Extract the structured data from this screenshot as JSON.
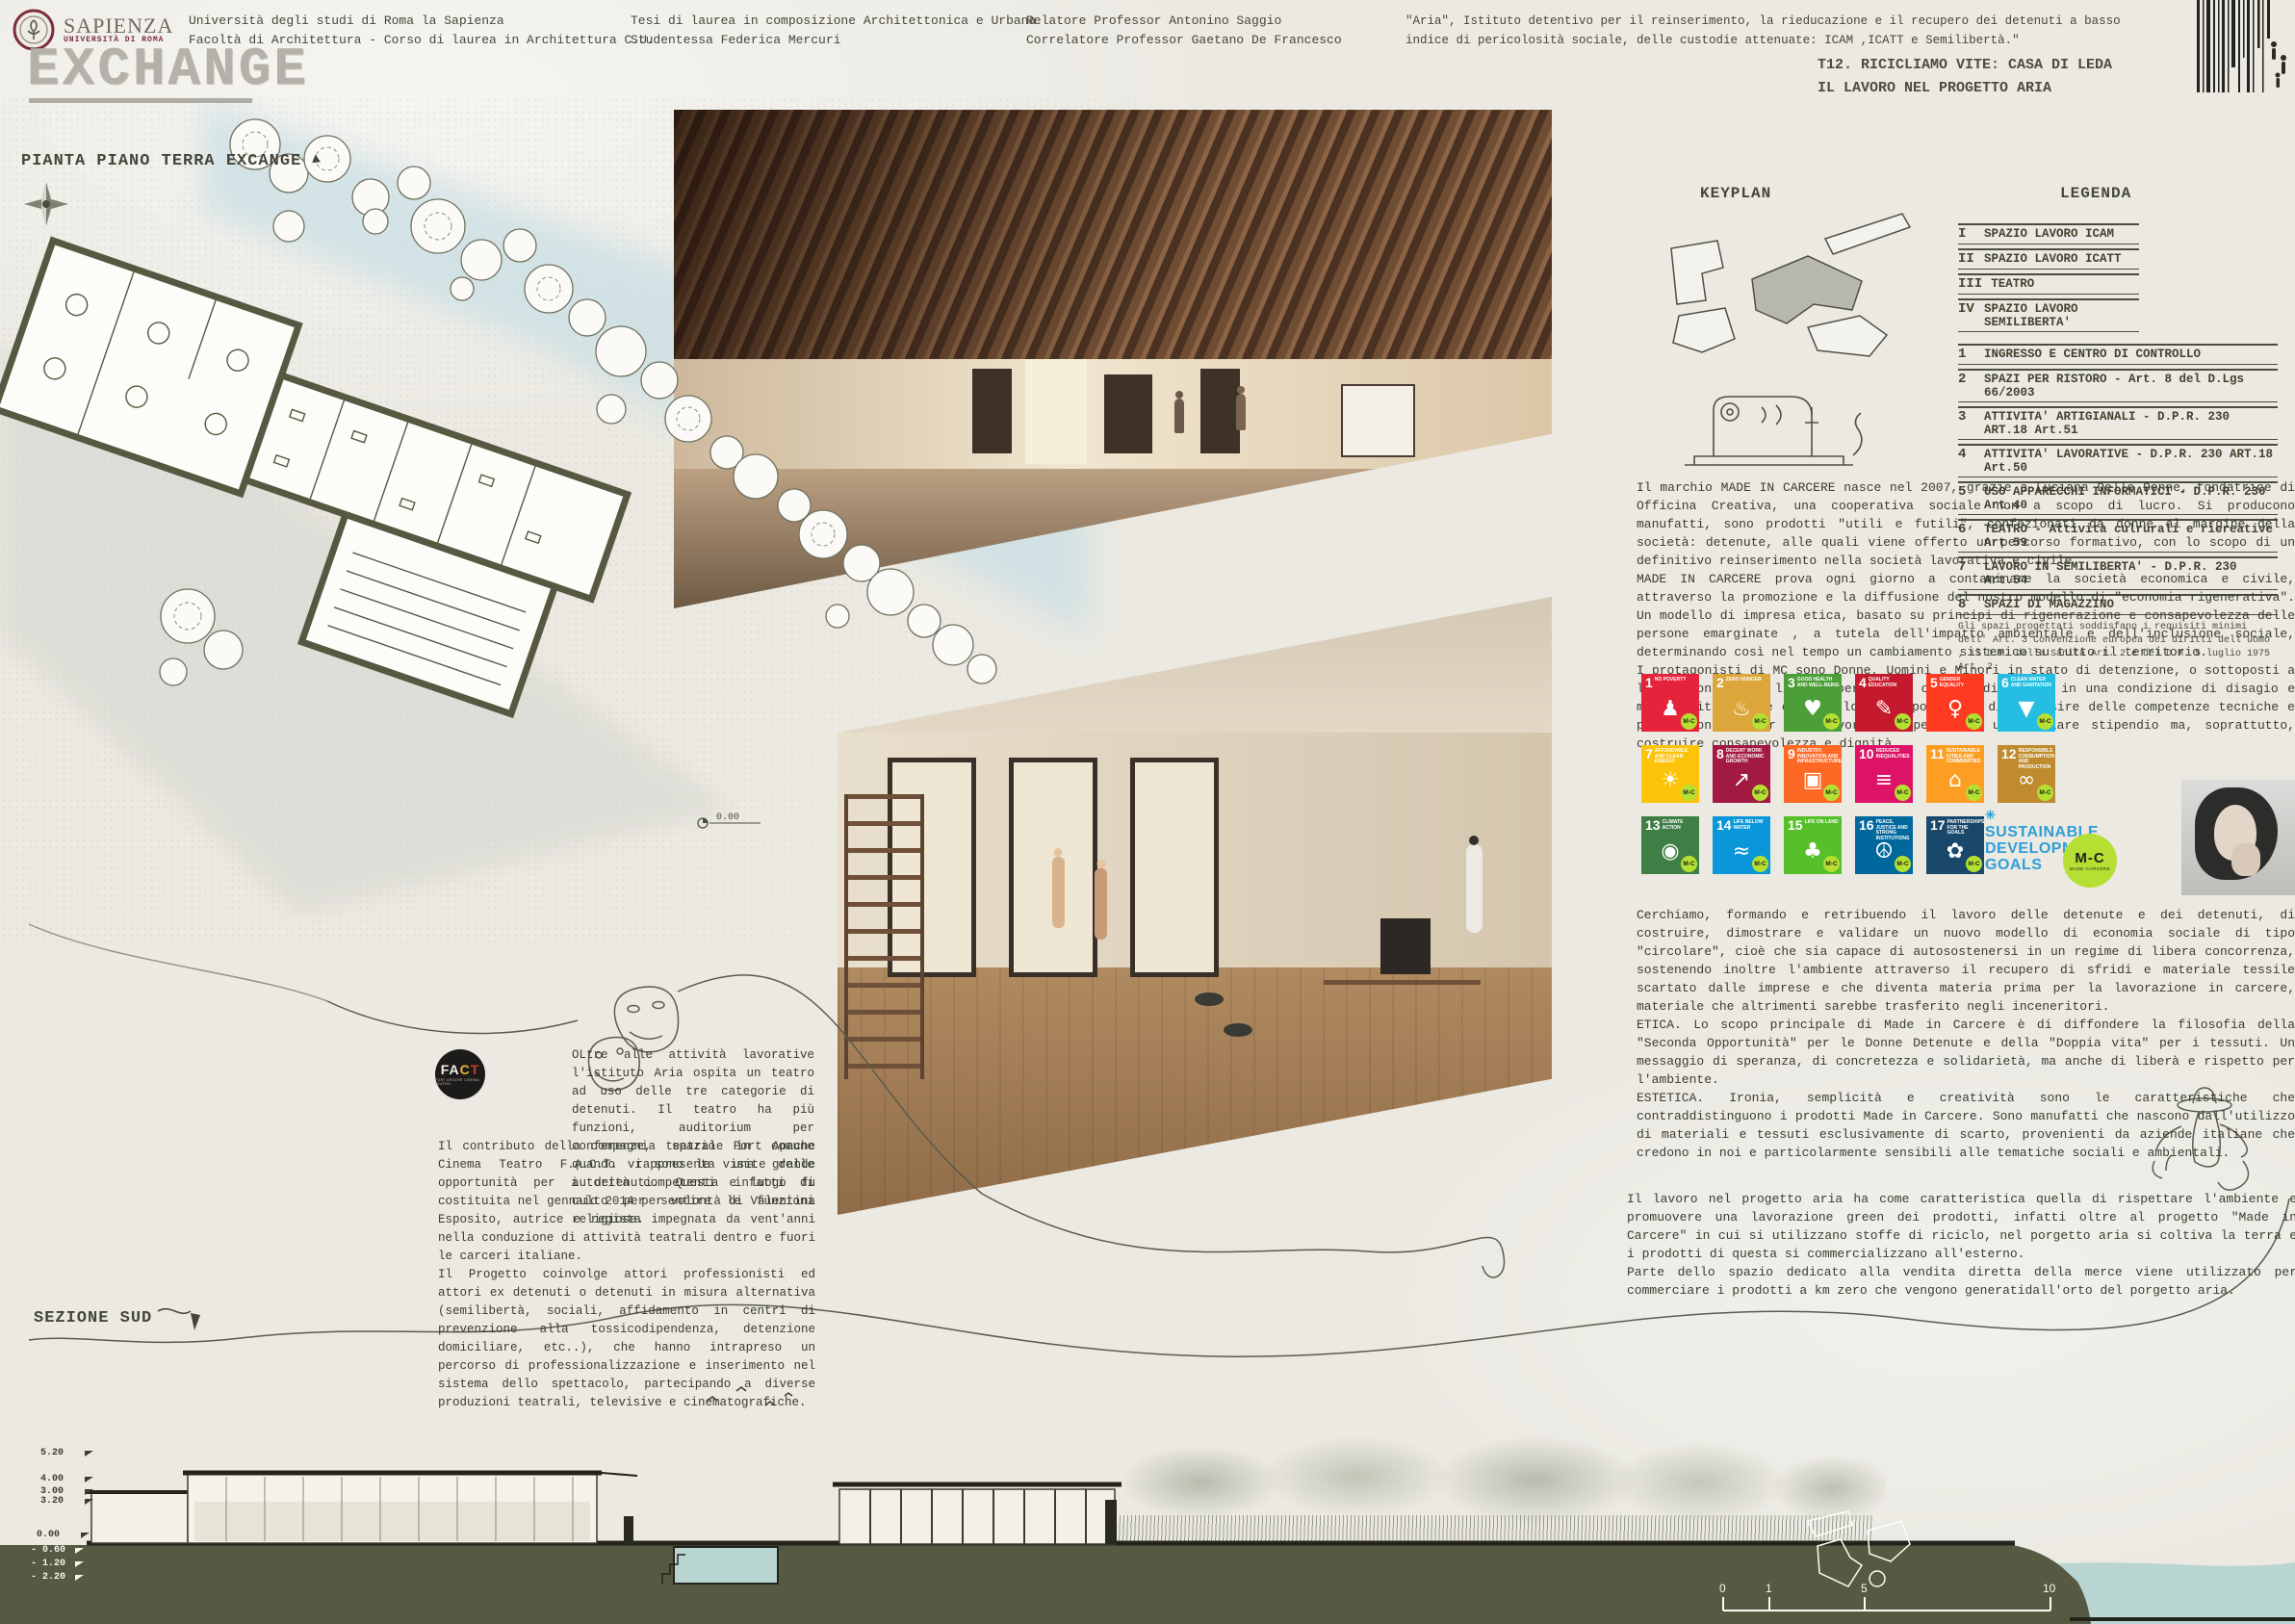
{
  "header": {
    "logo_title": "SAPIENZA",
    "logo_subtitle": "UNIVERSITÀ DI ROMA",
    "university": "Università degli studi di Roma la Sapienza",
    "faculty": "Facoltà di Architettura - Corso di laurea in Architettura C.U.",
    "thesis": "Tesi di laurea in composizione Architettonica e Urbana",
    "student": "Studentessa Federica Mercuri",
    "advisor": "Relatore Professor Antonino Saggio",
    "co_advisor": "Correlatore Professor Gaetano De Francesco",
    "quote": "\"Aria\",  Istituto detentivo per il reinserimento, la rieducazione  e il recupero dei detenuti a basso indice di pericolosità sociale, delle custodie attenuate: ICAM ,ICATT e Semilibertà.\"",
    "board_title_1": "T12. RICICLIAMO VITE: CASA DI LEDA",
    "board_title_2": "IL LAVORO NEL PROGETTO ARIA"
  },
  "titles": {
    "main": "EXCHANGE",
    "plan_label": "PIANTA PIANO TERRA EXCANGE",
    "section_label": "SEZIONE SUD",
    "keyplan": "KEYPLAN",
    "legend": "LEGENDA"
  },
  "plan": {
    "level_label": "0.00"
  },
  "legend": {
    "roman_items": [
      {
        "num": "I",
        "label": "SPAZIO LAVORO ICAM"
      },
      {
        "num": "II",
        "label": "SPAZIO LAVORO ICATT"
      },
      {
        "num": "III",
        "label": "TEATRO"
      },
      {
        "num": "IV",
        "label": "SPAZIO LAVORO SEMILIBERTA'"
      }
    ],
    "numbered_items": [
      {
        "num": "1",
        "label": "INGRESSO E CENTRO DI CONTROLLO"
      },
      {
        "num": "2",
        "label": "SPAZI PER RISTORO - Art. 8 del D.Lgs 66/2003"
      },
      {
        "num": "3",
        "label": "ATTIVITA' ARTIGIANALI - D.P.R. 230 ART.18 Art.51"
      },
      {
        "num": "4",
        "label": "ATTIVITA' LAVORATIVE - D.P.R. 230 ART.18 Art.50"
      },
      {
        "num": "5",
        "label": "USO APPARECCHI INFORMATICI - D.P.R. 230 Art.40"
      },
      {
        "num": "6",
        "label": "TEATRO - Attività culrurali e ricreative Art 59"
      },
      {
        "num": "7",
        "label": "LAVORO IN SEMILIBERTA' - D.P.R. 230 Art.54"
      },
      {
        "num": "8",
        "label": "SPAZI DI MAGAZZINO"
      }
    ],
    "note": "Gli spazi progettati soddisfano i requisiti minimi dell' Art. 3 Convenzione europea dei diritti dell'uomo , il D.M. della Sanità Art. 2  e del D.M. 5 luglio 1975 Art. 2"
  },
  "paragraphs": {
    "made_in_carcere": "Il marchio MADE IN CARCERE nasce nel 2007, grazie a Luciana Delle Donne, fondatrice di Officina Creativa, una cooperativa sociale non a scopo di lucro. Si producono manufatti, sono prodotti \"utili e futili\", confezionati da donne al margine della società: detenute, alle quali viene offerto un percorso formativo, con lo scopo di un definitivo reinserimento nella società lavorativa e civile.\nMADE IN CARCERE prova ogni giorno a contaminare la società economica e civile, attraverso la promozione e la diffusione del nostro modello di \"economia rigenerativa\". Un modello di impresa etica, basato su principi di rigenerazione e consapevolezza delle persone emarginate , a tutela dell'impatto ambientale e dell'inclusione sociale, determinando così nel tempo un cambiamento sistemico su tutto il territorio.\nI protagonisti di MC sono Donne, Uomini e Minori in stato di detenzione, o sottoposti a limitazioni della libertà personale, che quindi vivono in una condizione di disagio e marginalità. Viene offerta loro l'opportunità  di acquisire delle competenze tecniche e professionali, per poi lavorare e percepire un regolare stipendio  ma, soprattutto, costruire consapevolezza e dignità.",
    "cerchiamo": "Cerchiamo, formando e retribuendo il lavoro delle detenute e dei detenuti, di costruire, dimostrare e validare un nuovo modello di economia sociale di tipo \"circolare\", cioè che sia capace di autosostenersi in un regime di libera concorrenza, sostenendo inoltre l'ambiente attraverso il recupero di sfridi e materiale tessile scartato dalle imprese e che diventa materia prima per la lavorazione in carcere, materiale che altrimenti sarebbe  trasferito negli inceneritori.\nETICA. Lo scopo principale di Made in Carcere è di diffondere la filosofia della \"Seconda Opportunità\" per le Donne Detenute e della \"Doppia vita\" per i tessuti. Un messaggio di speranza, di concretezza e solidarietà, ma anche di liberà e rispetto per l'ambiente.\nESTETICA. Ironia, semplicità e creatività sono le caratteristiche che contraddistinguono i prodotti Made in Carcere. Sono manufatti che nascono dall'utilizzo di materiali e tessuti esclusivamente di scarto, provenienti da aziende italiane che credono in noi e particolarmente sensibili alle tematiche sociali e ambientali.",
    "lavoro_aria": "Il lavoro nel progetto aria ha come caratteristica quella di rispettare l'ambiente e promuovere una lavorazione green dei prodotti, infatti oltre al progetto \"Made in Carcere\" in cui si utilizzano stoffe di riciclo, nel porgetto aria si coltiva la terra e i prodotti di questa si commercializzano all'esterno.\nParte dello spazio dedicato alla vendita diretta della merce viene utilizzato per commerciare i prodotti a km zero che vengono generatidall'orto del porgetto aria.",
    "fact_intro": "OLtre alle attività lavorative l'istituto Aria ospita un teatro ad uso delle tre categorie di detenuti. Il teatro ha più funzioni, auditorium per conferenze, spazio in comune quando vi sono le visite delle autorità competenti e luogo di culto per sentire le funzioni religiose.",
    "fact_body": "Il contributo della compagnia teatrale Fort Apache Cinema Teatro F.A.C.T. rappresenta una grande opportunità per i detenuti. Questa infatti  fu costituita nel gennaio 2014 per volontà di Valentina Esposito, autrice e regista impegnata da  vent'anni nella conduzione di attività teatrali dentro e fuori le carceri italiane.\nIl Progetto coinvolge attori professionisti ed attori ex detenuti o detenuti in misura alternativa (semilibertà, sociali, affidamento in centri di prevenzione alla tossicodipendenza, detenzione domiciliare, etc..), che hanno intrapreso un percorso di professionalizzazione e inserimento nel sistema dello spettacolo, partecipando a diverse produzioni teatrali, televisive e cinematografiche."
  },
  "fact_logo": {
    "letters": [
      "F",
      "A",
      "C",
      "T"
    ],
    "letter_colors": [
      "#f2f0ea",
      "#f2f0ea",
      "#e9b23c",
      "#c23b2e"
    ],
    "sub": "FORT APACHE CINEMA TEATRO"
  },
  "sdg": {
    "badge": "M-C",
    "logo_line1": "SUSTAINABLE",
    "logo_line2": "DEVELOPMENT",
    "logo_line3": "GOALS",
    "mc_circle": {
      "text": "M-C",
      "sub": "MADE-CARCERE",
      "color": "#b5df33"
    },
    "tiles": [
      {
        "num": "1",
        "label": "NO POVERTY",
        "glyph": "♟",
        "color": "#e5243b"
      },
      {
        "num": "2",
        "label": "ZERO HUNGER",
        "glyph": "♨",
        "color": "#dda63a"
      },
      {
        "num": "3",
        "label": "GOOD HEALTH AND WELL-BEING",
        "glyph": "♥",
        "color": "#4c9f38"
      },
      {
        "num": "4",
        "label": "QUALITY EDUCATION",
        "glyph": "✎",
        "color": "#c5192d"
      },
      {
        "num": "5",
        "label": "GENDER EQUALITY",
        "glyph": "♀",
        "color": "#ff3a21"
      },
      {
        "num": "6",
        "label": "CLEAN WATER AND SANITATION",
        "glyph": "▼",
        "color": "#26bde2"
      },
      {
        "num": "7",
        "label": "AFFORDABLE AND CLEAN ENERGY",
        "glyph": "☀",
        "color": "#fcc30b"
      },
      {
        "num": "8",
        "label": "DECENT WORK AND ECONOMIC GROWTH",
        "glyph": "↗",
        "color": "#a21942"
      },
      {
        "num": "9",
        "label": "INDUSTRY, INNOVATION AND INFRASTRUCTURE",
        "glyph": "▣",
        "color": "#fd6925"
      },
      {
        "num": "10",
        "label": "REDUCED INEQUALITIES",
        "glyph": "≡",
        "color": "#dd1367"
      },
      {
        "num": "11",
        "label": "SUSTAINABLE CITIES AND COMMUNITIES",
        "glyph": "⌂",
        "color": "#fd9d24"
      },
      {
        "num": "12",
        "label": "RESPONSIBLE CONSUMPTION AND PRODUCTION",
        "glyph": "∞",
        "color": "#bf8b2e"
      },
      {
        "num": "13",
        "label": "CLIMATE ACTION",
        "glyph": "◉",
        "color": "#3f7e44"
      },
      {
        "num": "14",
        "label": "LIFE BELOW WATER",
        "glyph": "≈",
        "color": "#0a97d9"
      },
      {
        "num": "15",
        "label": "LIFE ON LAND",
        "glyph": "♣",
        "color": "#56c02b"
      },
      {
        "num": "16",
        "label": "PEACE, JUSTICE AND STRONG INSTITUTIONS",
        "glyph": "☮",
        "color": "#00689d"
      },
      {
        "num": "17",
        "label": "PARTNERSHIPS FOR THE GOALS",
        "glyph": "✿",
        "color": "#19486a"
      }
    ]
  },
  "section": {
    "levels": [
      {
        "label": "5.20"
      },
      {
        "label": "4.00"
      },
      {
        "label": "3.00"
      },
      {
        "label": "3.20"
      },
      {
        "label": "0.00"
      },
      {
        "label": "- 0.60"
      },
      {
        "label": "- 1.20"
      },
      {
        "label": "- 2.20"
      }
    ],
    "scale_marks": [
      "0",
      "1",
      "5",
      "10"
    ]
  }
}
